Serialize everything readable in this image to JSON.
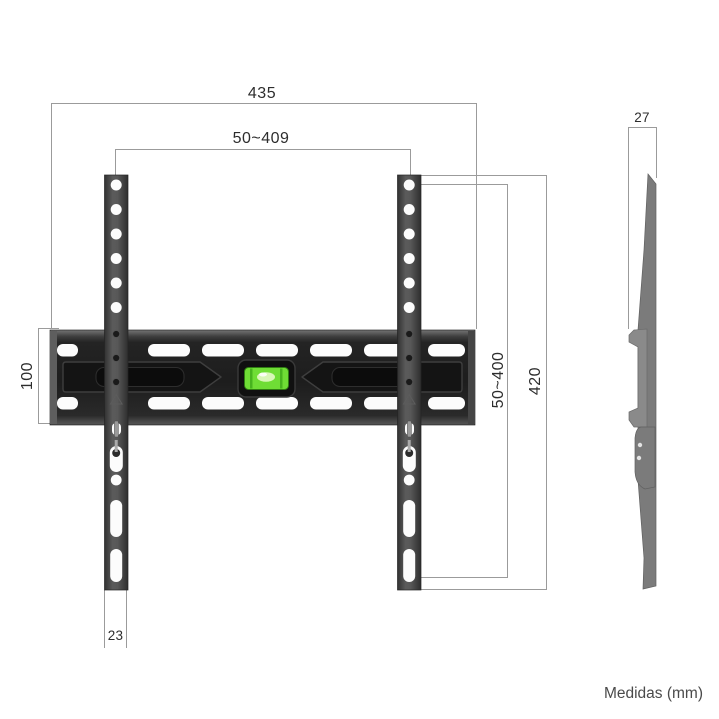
{
  "diagram": {
    "title_hint": "TV wall mount bracket dimensional drawing",
    "front_view": {
      "dim_total_width": "435",
      "dim_hole_width_range": "50~409",
      "dim_rail_height": "100",
      "dim_hole_height_range": "50~400",
      "dim_total_height": "420",
      "dim_strap_width": "23"
    },
    "side_view": {
      "dim_depth": "27"
    },
    "footer": {
      "units_label": "Medidas (mm)"
    },
    "colors": {
      "background": "#ffffff",
      "rail_dark": "#242424",
      "strap_gray": "#4a4a4a",
      "side_profile_gray": "#7b7b7b",
      "level_green": "#6fdd35",
      "dimension_line": "#9b9b9b",
      "label_text": "#2d2d2d"
    }
  }
}
